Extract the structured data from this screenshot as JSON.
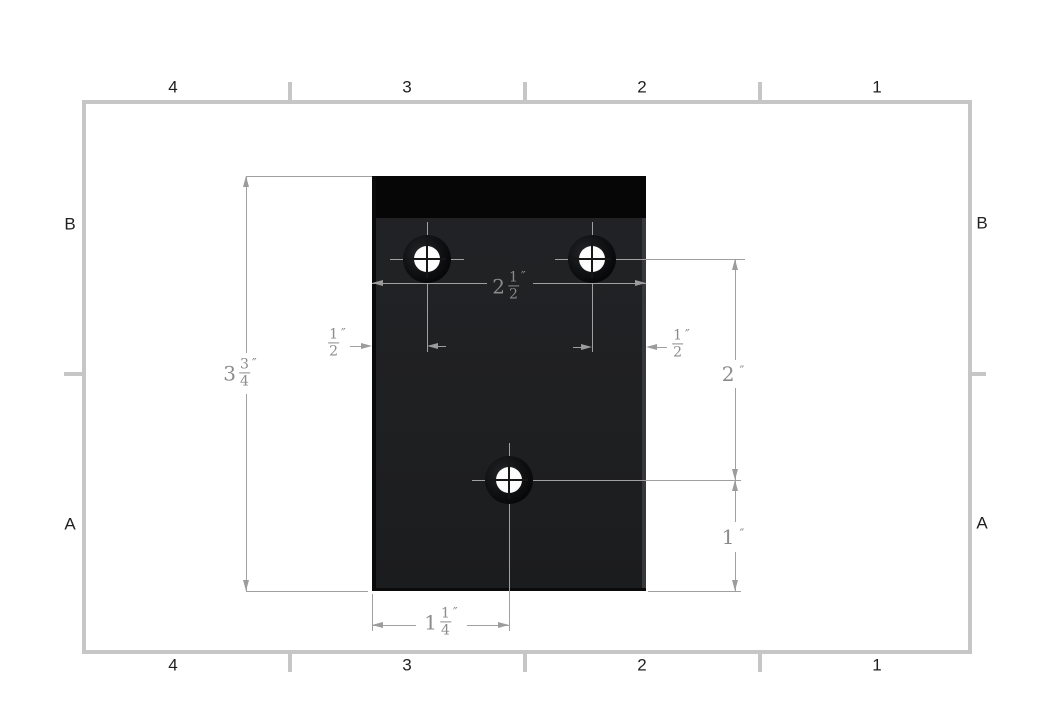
{
  "sheet": {
    "border_zones": {
      "top": [
        "4",
        "3",
        "2",
        "1"
      ],
      "bottom": [
        "4",
        "3",
        "2",
        "1"
      ],
      "left": [
        "B",
        "A"
      ],
      "right": [
        "B",
        "A"
      ]
    }
  },
  "dimensions": {
    "plate_height": {
      "whole": "3",
      "num": "3",
      "den": "4",
      "unit": "″"
    },
    "plate_width": {
      "whole": "2",
      "num": "1",
      "den": "2",
      "unit": "″"
    },
    "left_hole_offset": {
      "num": "1",
      "den": "2",
      "unit": "″"
    },
    "right_hole_offset": {
      "num": "1",
      "den": "2",
      "unit": "″"
    },
    "hole_row_spacing": {
      "value": "2",
      "unit": "″"
    },
    "bottom_hole_height": {
      "value": "1",
      "unit": "″"
    },
    "bottom_hole_offset": {
      "whole": "1",
      "num": "1",
      "den": "4",
      "unit": "″"
    }
  },
  "colors": {
    "frame_gray": "#c6c6c6",
    "plate_body": "#1f2022",
    "plate_flange": "#060607",
    "dimension_line": "#a0a0a0",
    "dimension_text": "#8b8b8b",
    "hole_fill": "#fcfcfc"
  }
}
